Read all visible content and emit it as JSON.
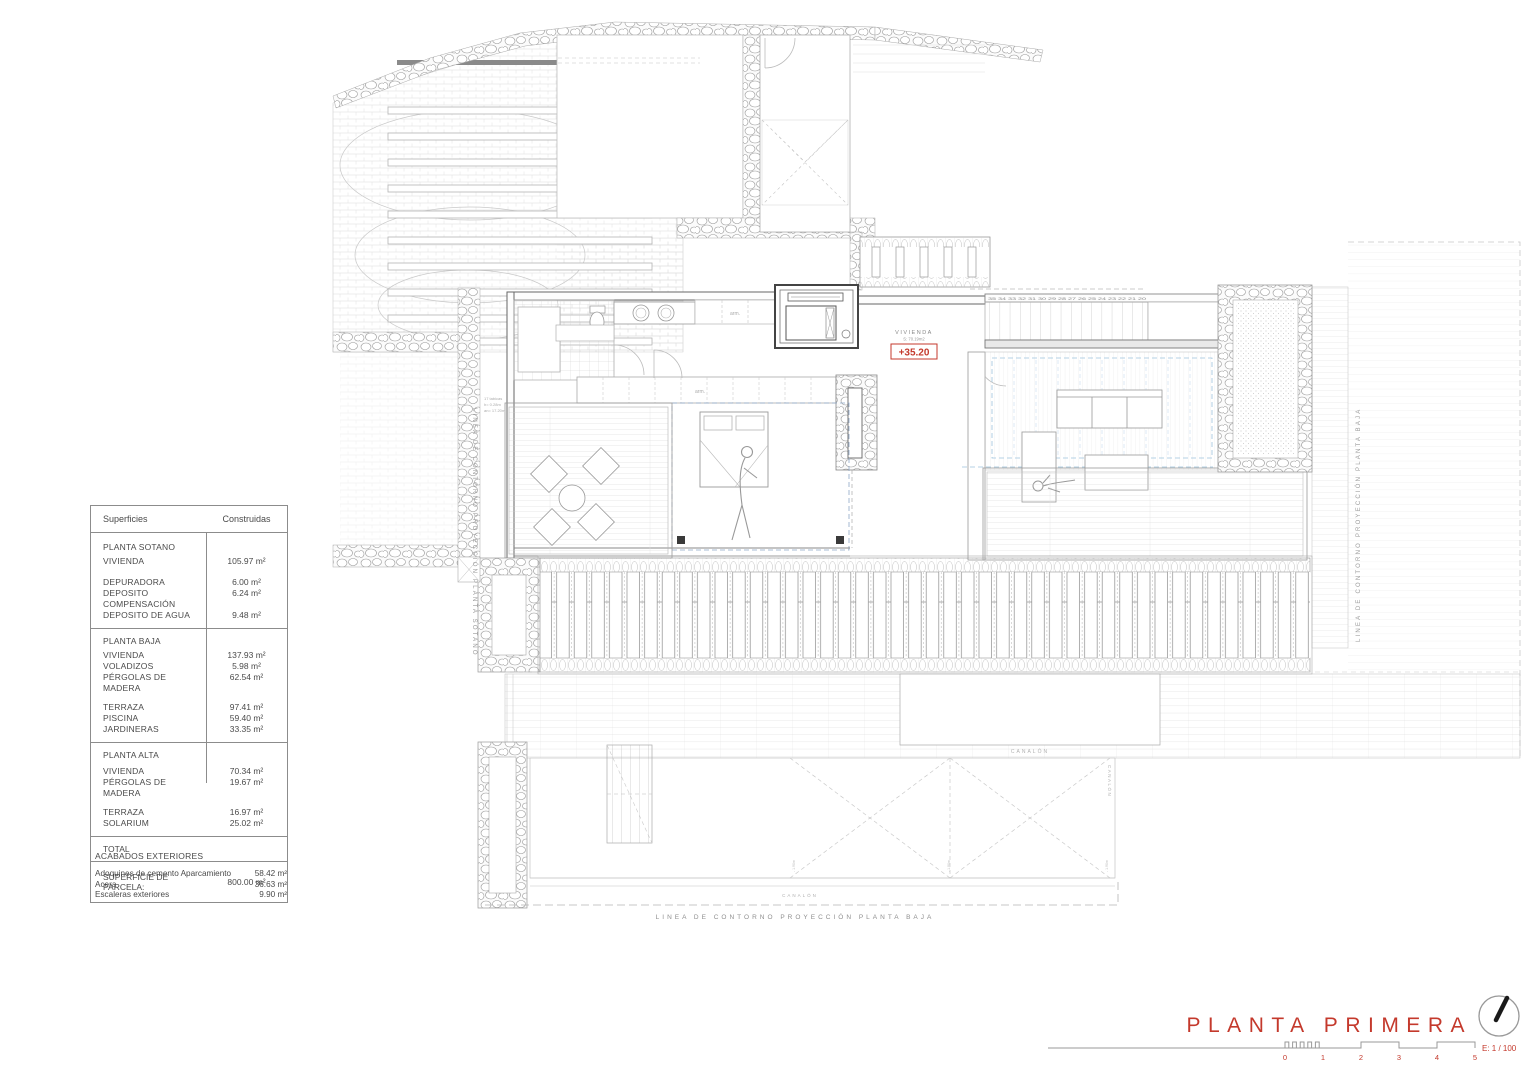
{
  "colors": {
    "accent_red": "#c4392c",
    "line_gray": "#9a9a9a",
    "wall_gray": "#555555",
    "blue_dash": "#9dc3dd"
  },
  "areas_table": {
    "col1": "Superficies",
    "col2": "Construidas",
    "rows": [
      {
        "label": "PLANTA SOTANO",
        "value": ""
      },
      {
        "label": "VIVIENDA",
        "value": "105.97 m²"
      },
      {
        "label": "DEPURADORA",
        "value": "6.00 m²"
      },
      {
        "label": "DEPOSITO COMPENSACIÓN",
        "value": "6.24 m²"
      },
      {
        "label": "DEPOSITO DE AGUA",
        "value": "9.48 m²"
      },
      {
        "label": "PLANTA BAJA",
        "value": ""
      },
      {
        "label": "VIVIENDA",
        "value": "137.93 m²"
      },
      {
        "label": "VOLADIZOS",
        "value": "5.98 m²"
      },
      {
        "label": "PÉRGOLAS DE MADERA",
        "value": "62.54 m²"
      },
      {
        "label": "TERRAZA",
        "value": "97.41 m²"
      },
      {
        "label": "PISCINA",
        "value": "59.40 m²"
      },
      {
        "label": "JARDINERAS",
        "value": "33.35 m²"
      },
      {
        "label": "PLANTA ALTA",
        "value": ""
      },
      {
        "label": "VIVIENDA",
        "value": "70.34 m²"
      },
      {
        "label": "PÉRGOLAS DE MADERA",
        "value": "19.67 m²"
      },
      {
        "label": "TERRAZA",
        "value": "16.97 m²"
      },
      {
        "label": "SOLARIUM",
        "value": "25.02 m²"
      },
      {
        "label": "TOTAL",
        "value": ""
      },
      {
        "label": "SUPERFICIE DE PARCELA:",
        "value": "800.00 m²"
      }
    ]
  },
  "acabados": {
    "title": "ACABADOS EXTERIORES",
    "items": [
      {
        "label": "Adoquines de cemento Aparcamiento",
        "value": "58.42 m²"
      },
      {
        "label": "Acera",
        "value": "36.63 m²"
      },
      {
        "label": "Escaleras exteriores",
        "value": "9.90 m²"
      }
    ]
  },
  "plan": {
    "vivienda_label": "VIVIENDA",
    "vivienda_area": "S: 70.19m2",
    "level": "+35.20",
    "contour_left": "LINEA DE CONTORNO PROYECCIÓN PLANTA SOTANO",
    "contour_right": "LINEA DE CONTORNO PROYECCIÓN PLANTA BAJA",
    "contour_bottom": "LINEA DE CONTORNO PROYECCIÓN PLANTA BAJA",
    "canalon": "CANALÓN",
    "closet_label": "arm.",
    "stair_numbers": "35 34 33 32 31 30 29 28 27 26 25 24 23 22 21 20",
    "stair_note_1": "17 tabicas",
    "stair_note_2": "h= 0.28m",
    "stair_note_3": "an= 17.20m",
    "roof_dim": "- 1.90m"
  },
  "title_block": {
    "title": "PLANTA PRIMERA",
    "scale": "E: 1 / 100",
    "ticks": [
      "0",
      "1",
      "2",
      "3",
      "4",
      "5"
    ]
  }
}
